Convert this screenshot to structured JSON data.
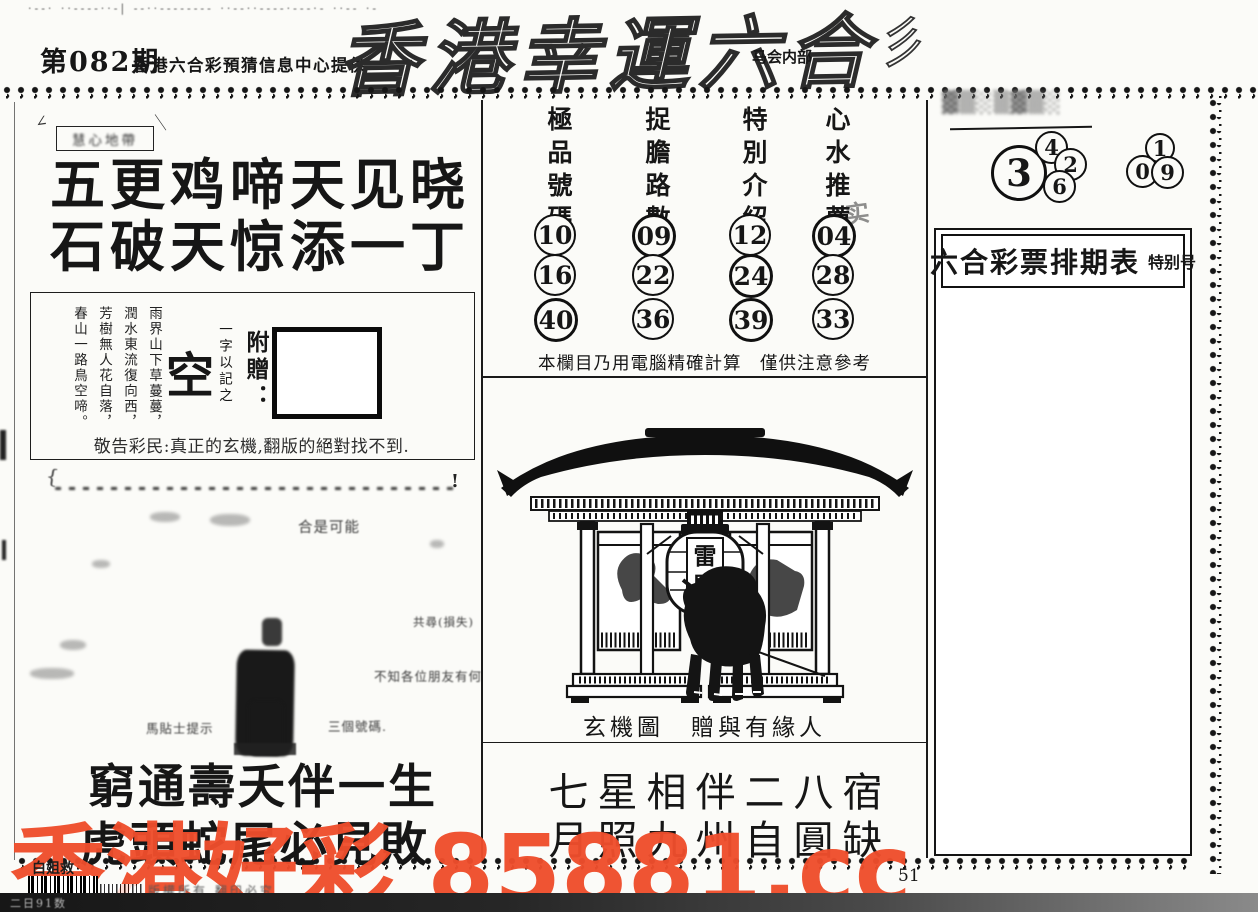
{
  "page": {
    "top_marks": "·‐‐· ··‐‐‐‐··‐| ‐‐··‐‐‐‐‐‐‐‐ ··‐‐··‐‐‐‐·‐‐‐·‐ ··‐‐ ·‐",
    "issue": "第082期",
    "provider": "香港六合彩預猜信息中心提供",
    "title": "香港幸運六合",
    "title_note": "马会内部",
    "scribble": "彡",
    "page_number": "51"
  },
  "left": {
    "tag_label": "慧心地帶",
    "tag_tick_left": "∠",
    "tag_tick_right": "＼",
    "poem_line1": "五更鸡啼天见晓",
    "poem_line2": "石破天惊添一丁",
    "vertical_poem": [
      "雨界山下草蔓蔓，",
      "潤水東流復向西，",
      "芳樹無人花自落，",
      "春山一路鳥空啼。"
    ],
    "kong_char": "空",
    "kong_note": "一字以記之",
    "gift_label": "附贈：",
    "notice": "敬告彩民:真正的玄機,翻版的絕對找不到.",
    "smudge": {
      "smear_start": "{",
      "smear_end": "!",
      "fragments": [
        "合是可能",
        "共尋(損失)",
        "不知各位朋友有何",
        "馬貼士提示",
        "三個號碼."
      ]
    },
    "bottom_poem_line1": "窮通壽夭伴一生",
    "bottom_poem_line2": "虎頭蛇尾必見敗",
    "barcode_label": "白姐救",
    "copyright": "版權所有 翻印必究"
  },
  "center": {
    "columns": [
      {
        "header": "極品號碼",
        "numbers": [
          "10",
          "16",
          "40"
        ]
      },
      {
        "header": "捉膽路數",
        "numbers": [
          "09",
          "22",
          "36"
        ]
      },
      {
        "header": "特別介紹",
        "numbers": [
          "12",
          "24",
          "39"
        ]
      },
      {
        "header": "心水推薦",
        "numbers": [
          "04",
          "28",
          "33"
        ]
      }
    ],
    "stamp_char": "实",
    "note": "本欄目乃用電腦精確計算　僅供注意參考",
    "lantern_top": "雷",
    "lantern_bottom": "門",
    "caption": "玄機圖　贈與有緣人",
    "bottom_poem_line1": "七星相伴二八宿",
    "bottom_poem_line2": "月照九州自圓缺"
  },
  "right": {
    "smudge_label": "▓▒░▒▓▒░",
    "big_number": "3",
    "cluster1": [
      "4",
      "2",
      "6"
    ],
    "cluster2": [
      "1",
      "0",
      "9"
    ],
    "schedule_title": "六合彩票排期表",
    "schedule_badge": "特别号"
  },
  "watermark": {
    "text": "香港好彩 85881.cc",
    "color": "#ef4e2c"
  },
  "bottom_bar": {
    "marks": "二日91数"
  }
}
